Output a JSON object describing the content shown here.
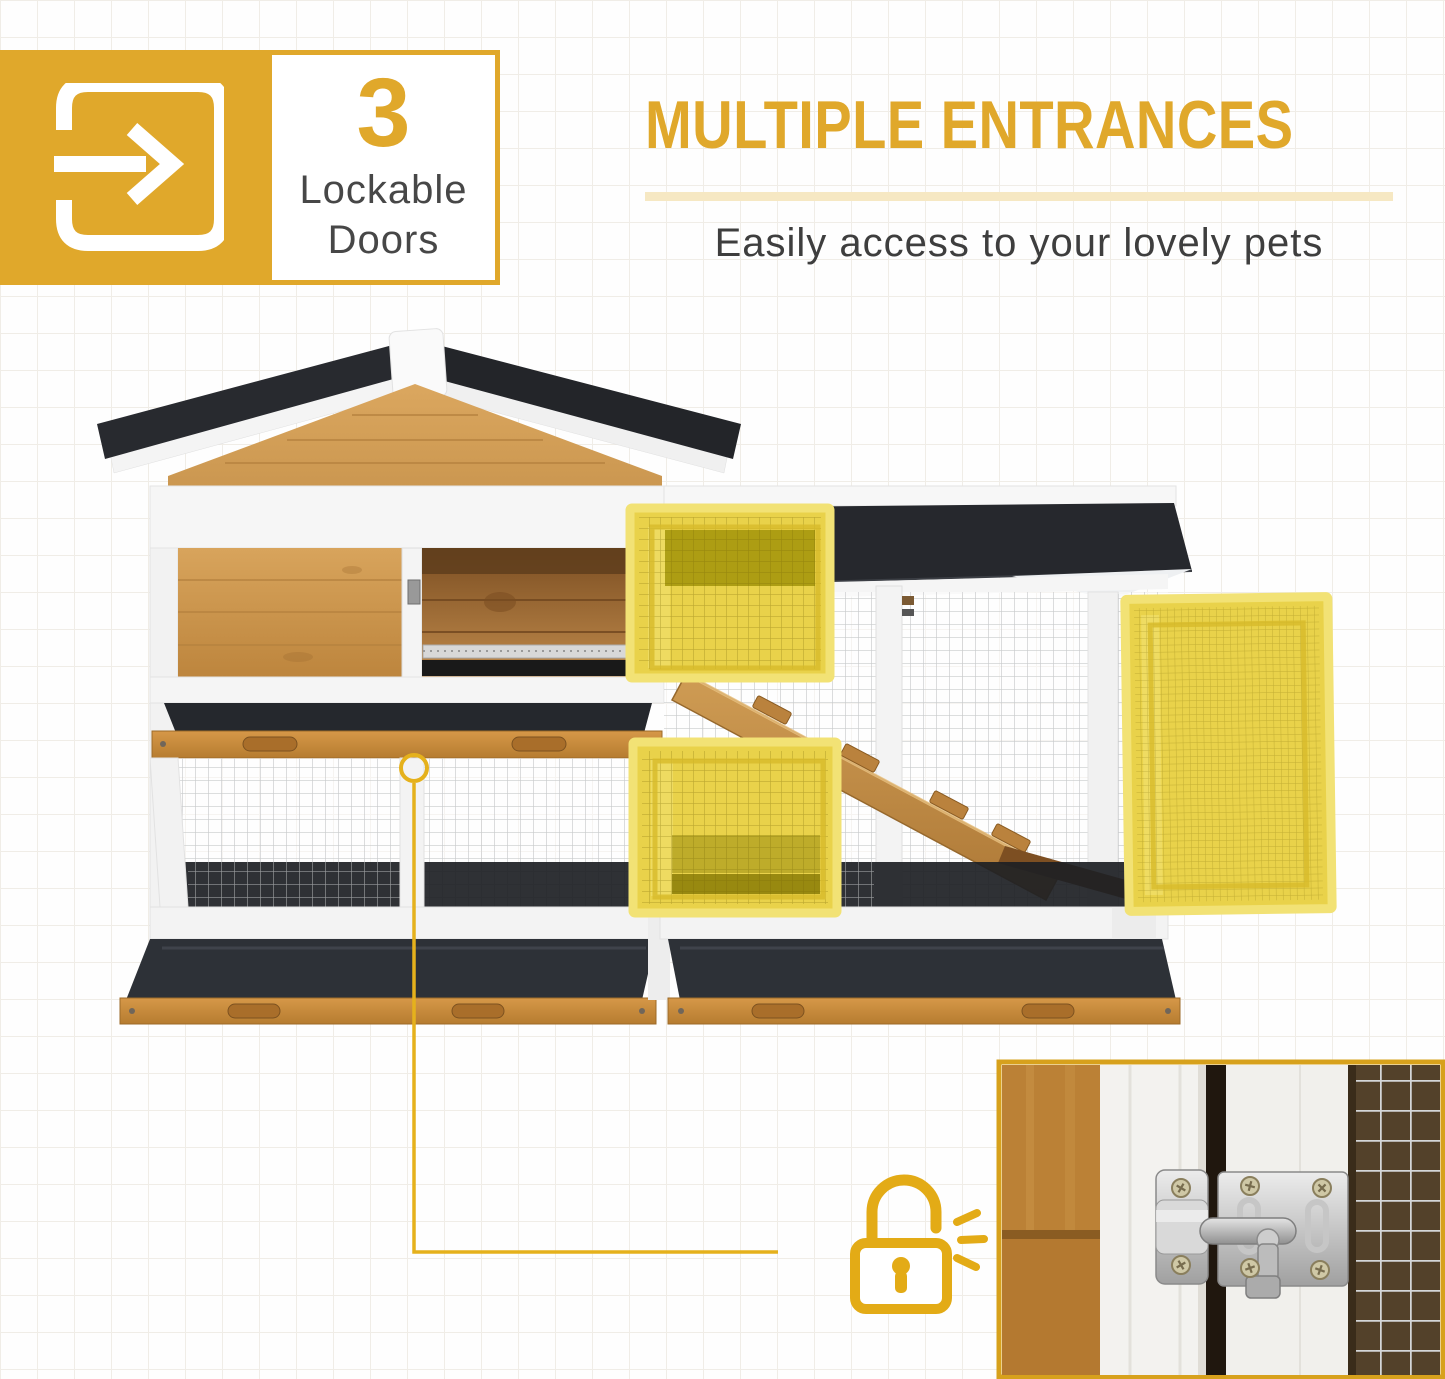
{
  "badge": {
    "icon": "enter-door-arrow-icon",
    "number": "3",
    "line1": "Lockable",
    "line2": "Doors"
  },
  "header": {
    "title": "MULTIPLE ENTRANCES",
    "subtitle": "Easily access to your lovely pets"
  },
  "colors": {
    "brand_yellow": "#E0A82B",
    "annotation_yellow": "#E3AB16",
    "highlight_door_yellow": "#E9D24A",
    "underline_cream": "#F6E8C3",
    "roof_black": "#26282D",
    "wood_tan": "#C9914A",
    "tray_charcoal": "#2D3137",
    "text_dark": "#3E3E3E"
  },
  "illustration": {
    "subject": "two-story wooden rabbit hutch with asphalt roof and wire-mesh run",
    "highlighted_parts": [
      "upper-hutch-mesh-door",
      "lower-run-mesh-door",
      "side-run-mesh-door"
    ],
    "annotations": {
      "callout": "latch-callout-circle",
      "connector": "elbow-connector-line",
      "icon": "padlock-unlocked-icon",
      "motion_marks": "click-motion-dashes-icon"
    },
    "inset": "door-latch-closeup-photo"
  }
}
